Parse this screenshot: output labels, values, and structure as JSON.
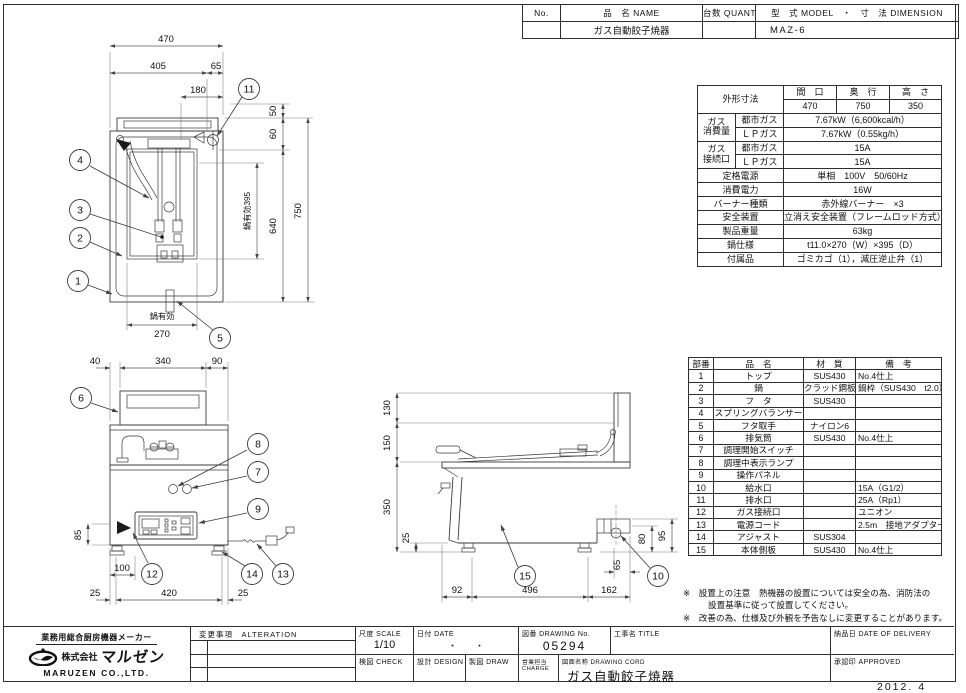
{
  "plate": {
    "no_label": "No.",
    "name_label": "品　名 NAME",
    "qty_label": "台数 QUANTITY",
    "model_dim_label": "型　式 MODEL　・　寸　法 DIMENSION",
    "name_value": "ガス自動餃子焼器",
    "model_value": "MAZ-6"
  },
  "spec": {
    "dim_label": "外形寸法",
    "w_label": "間　口",
    "d_label": "奥　行",
    "h_label": "高　さ",
    "w": "470",
    "d": "750",
    "h": "350",
    "gas1": "ガス",
    "gas2": "消費量",
    "city": "都市ガス",
    "lp": "ＬＰガス",
    "city_val": "7.67kW（6,600kcal/h）",
    "lp_val": "7.67kW（0.55kg/h）",
    "conn1": "ガス",
    "conn2": "接続口",
    "conn_city": "都市ガス",
    "conn_lp": "ＬＰガス",
    "conn_city_val": "15A",
    "conn_lp_val": "15A",
    "power_label": "定格電源",
    "power_val": "単相　100V　50/60Hz",
    "consumption_label": "消費電力",
    "consumption_val": "16W",
    "burner_label": "バーナー種類",
    "burner_val": "赤外線バーナー　×3",
    "safety_label": "安全装置",
    "safety_val": "立消え安全装置（フレームロッド方式）",
    "weight_label": "製品重量",
    "weight_val": "63kg",
    "pan_label": "鍋仕様",
    "pan_val": "t11.0×270（W）×395（D）",
    "acc_label": "付属品",
    "acc_val": "ゴミカゴ（1），減圧逆止弁（1）"
  },
  "parts": {
    "headers": [
      "部番",
      "品　名",
      "材　質",
      "備　考"
    ],
    "rows": [
      [
        "1",
        "トップ",
        "SUS430",
        "No.4仕上"
      ],
      [
        "2",
        "鍋",
        "クラッド鋼板",
        "鍋枠（SUS430　t2.0）"
      ],
      [
        "3",
        "フ　タ",
        "SUS430",
        ""
      ],
      [
        "4",
        "スプリングバランサー",
        "",
        ""
      ],
      [
        "5",
        "フタ取手",
        "ナイロン6",
        ""
      ],
      [
        "6",
        "排気筒",
        "SUS430",
        "No.4仕上"
      ],
      [
        "7",
        "調理開始スイッチ",
        "",
        ""
      ],
      [
        "8",
        "調理中表示ランプ",
        "",
        ""
      ],
      [
        "9",
        "操作パネル",
        "",
        ""
      ],
      [
        "10",
        "給水口",
        "",
        "15A（G1/2）"
      ],
      [
        "11",
        "排水口",
        "",
        "25A（Rp1）"
      ],
      [
        "12",
        "ガス接続口",
        "",
        "ユニオン"
      ],
      [
        "13",
        "電源コード",
        "",
        "2.5m　接地アダプター付"
      ],
      [
        "14",
        "アジャスト",
        "SUS304",
        ""
      ],
      [
        "15",
        "本体側板",
        "SUS430",
        "No.4仕上"
      ]
    ]
  },
  "notes": {
    "line1": "※　設置上の注意　熱機器の設置については安全の為、消防法の",
    "line2": "設置基準に従って設置してください。",
    "line3": "※　改善の為、仕様及び外観を予告なしに変更することがあります。"
  },
  "maker": {
    "tagline": "業務用総合厨房機器メーカー",
    "company_prefix": "株式会社",
    "brand": "マルゼン",
    "company_en": "MARUZEN  CO.,LTD."
  },
  "titleblock": {
    "alteration_label": "変更事項　ALTERATION",
    "scale_label": "尺度  SCALE",
    "scale_value": "1/10",
    "date_label": "日付  DATE",
    "date_value": "・　　・",
    "dwgno_label": "図番  DRAWING No.",
    "dwgno_value": "05294",
    "title_label": "工事名  TITLE",
    "delivery_label": "納品日  DATE OF DELIVERY",
    "check_label": "検図  CHECK",
    "design_label": "設計  DESIGN",
    "draw_label": "製図  DRAW",
    "charge_label": "営業担当 CHARGE",
    "name_label": "図面名称 DRAWING CORD",
    "name_value": "ガス自動餃子焼器",
    "approved_label": "承認印  APPROVED",
    "stamp_date": "2012. 4"
  },
  "drawings": {
    "plan": {
      "d470": "470",
      "d405": "405",
      "d65": "65",
      "d180": "180",
      "d50": "50",
      "d60": "60",
      "d750": "750",
      "d640": "640",
      "d395": "鍋有効395",
      "pan_eff": "鍋有効",
      "d270": "270",
      "c11": "11",
      "c4": "4",
      "c3": "3",
      "c2": "2",
      "c1": "1",
      "c5": "5"
    },
    "front": {
      "d40": "40",
      "d340": "340",
      "d90": "90",
      "d85": "85",
      "d100": "100",
      "d25l": "25",
      "d420": "420",
      "d25r": "25",
      "c6": "6",
      "c8": "8",
      "c7": "7",
      "c9": "9",
      "c12": "12",
      "c14": "14",
      "c13": "13"
    },
    "side": {
      "d130": "130",
      "d150": "150",
      "d350": "350",
      "d25": "25",
      "d92": "92",
      "d496": "496",
      "d162": "162",
      "d80": "80",
      "d95": "95",
      "d65": "65",
      "c15": "15",
      "c10": "10"
    }
  }
}
